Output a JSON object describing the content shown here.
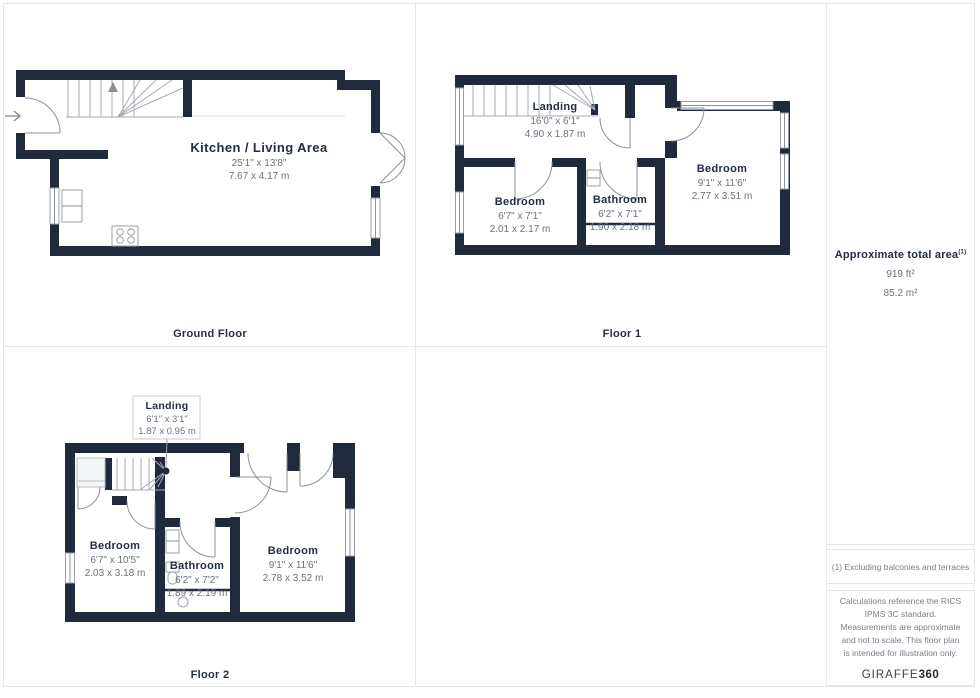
{
  "floors": {
    "ground": {
      "label": "Ground Floor",
      "rooms": {
        "kitchen": {
          "name": "Kitchen / Living Area",
          "imperial": "25'1\" x 13'8\"",
          "metric": "7.67 x 4.17 m"
        }
      }
    },
    "floor1": {
      "label": "Floor 1",
      "rooms": {
        "landing": {
          "name": "Landing",
          "imperial": "16'0\" x 6'1\"",
          "metric": "4.90 x 1.87 m"
        },
        "bedroom_small": {
          "name": "Bedroom",
          "imperial": "6'7\" x 7'1\"",
          "metric": "2.01 x 2.17 m"
        },
        "bathroom": {
          "name": "Bathroom",
          "imperial": "6'2\" x 7'1\"",
          "metric": "1.90 x 2.18 m"
        },
        "bedroom_large": {
          "name": "Bedroom",
          "imperial": "9'1\" x 11'6\"",
          "metric": "2.77 x 3.51 m"
        }
      }
    },
    "floor2": {
      "label": "Floor 2",
      "rooms": {
        "landing": {
          "name": "Landing",
          "imperial": "6'1\" x 3'1\"",
          "metric": "1.87 x 0.95 m"
        },
        "bedroom_small": {
          "name": "Bedroom",
          "imperial": "6'7\" x 10'5\"",
          "metric": "2.03 x 3.18 m"
        },
        "bathroom": {
          "name": "Bathroom",
          "imperial": "6'2\" x 7'2\"",
          "metric": "1.89 x 2.19 m"
        },
        "bedroom_large": {
          "name": "Bedroom",
          "imperial": "9'1\" x 11'6\"",
          "metric": "2.78 x 3.52 m"
        }
      }
    }
  },
  "sidebar": {
    "total_area_title": "Approximate total area",
    "total_area_superscript": "(1)",
    "area_imperial": "919 ft²",
    "area_metric": "85.2 m²",
    "footnote": "(1) Excluding balconies and terraces",
    "disclaimer": "Calculations reference the RICS IPMS 3C standard. Measurements are approximate and not to scale. This floor plan is intended for illustration only.",
    "brand_name": "GIRAFFE",
    "brand_suffix": "360"
  },
  "colors": {
    "wall": "#1f2a3c",
    "dim_text": "#6a7280",
    "border": "#e5e6e8"
  }
}
